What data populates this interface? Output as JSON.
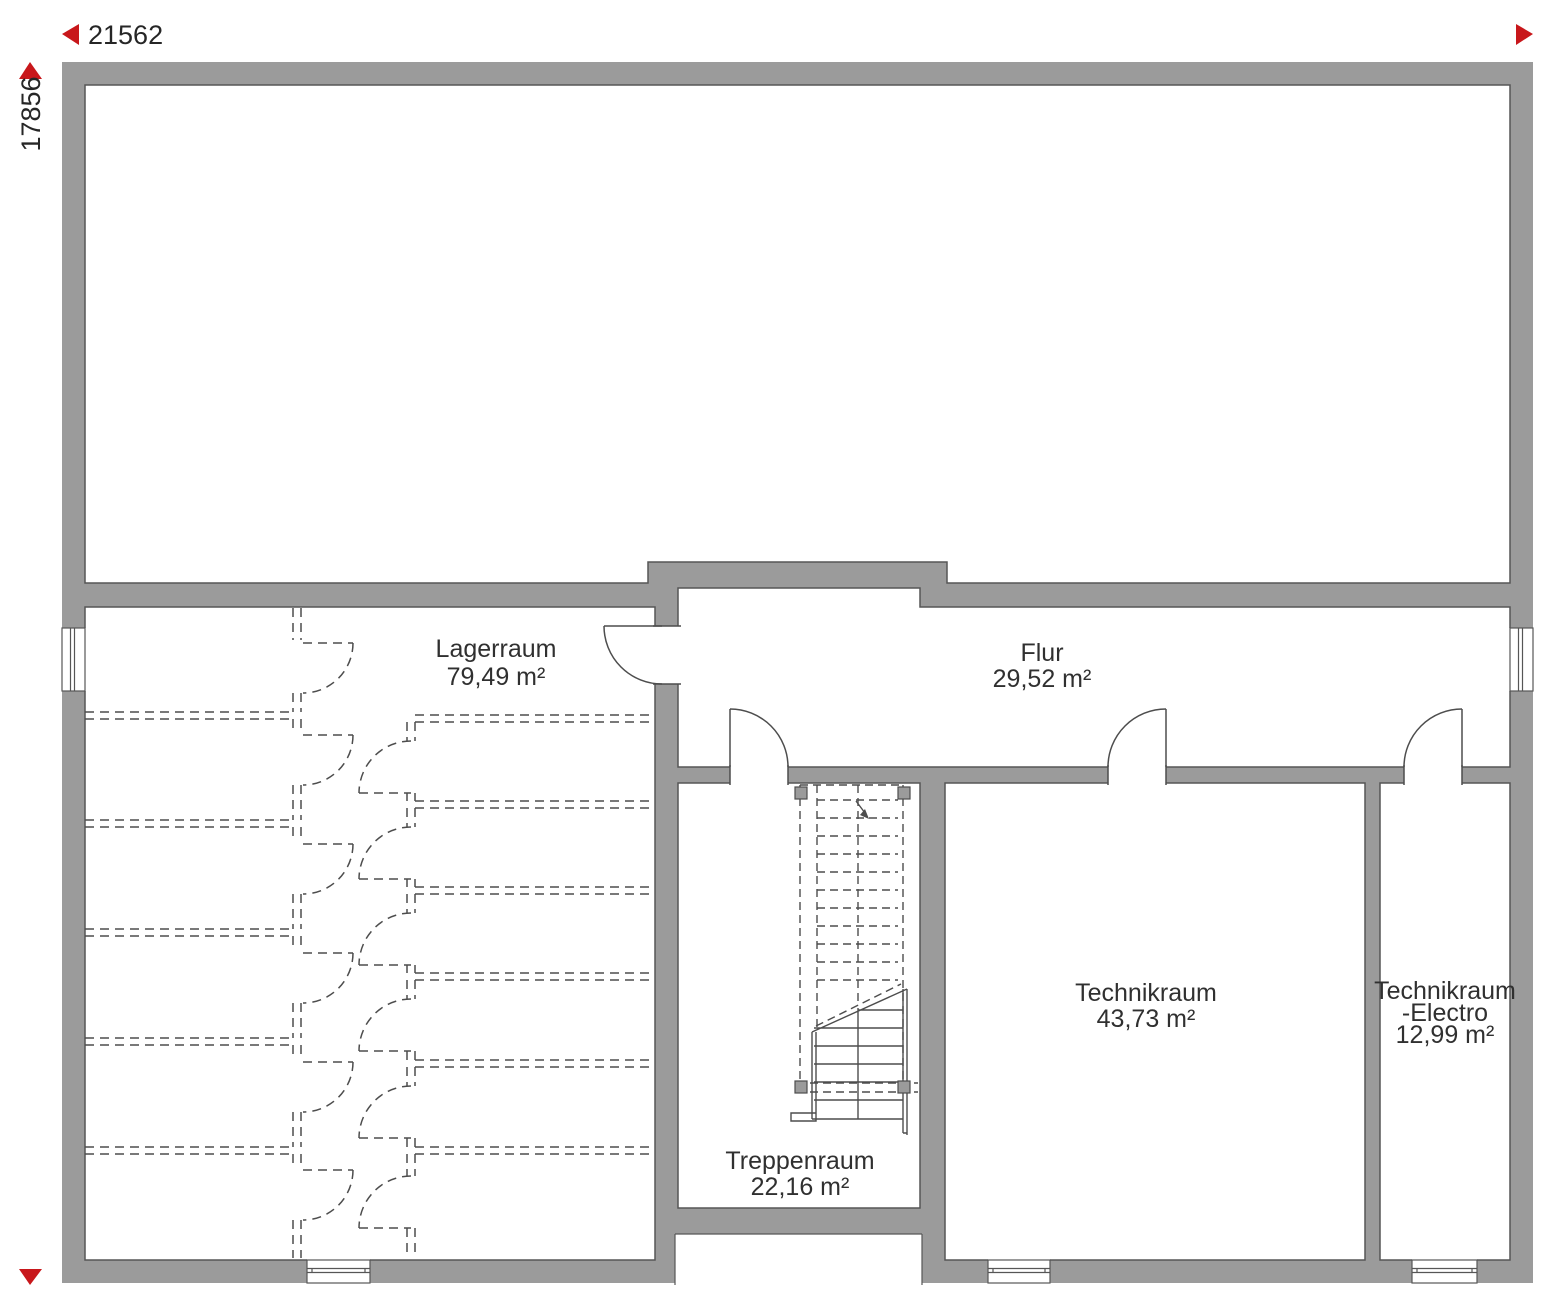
{
  "colors": {
    "wall_fill": "#9b9b9b",
    "wall_outline": "#565656",
    "line": "#4d4d4d",
    "label_text": "#303030",
    "marker_red": "#c8171b"
  },
  "dimension_markers": {
    "horizontal": {
      "value": "21562",
      "left_arrow": "triangle-left-icon",
      "right_arrow": "triangle-right-icon"
    },
    "vertical": {
      "value": "17856",
      "top_arrow": "triangle-up-icon",
      "bottom_arrow": "triangle-down-icon"
    }
  },
  "rooms": {
    "lagerraum": {
      "name": "Lagerraum",
      "area": "79,49 m²"
    },
    "flur": {
      "name": "Flur",
      "area": "29,52 m²"
    },
    "treppenraum": {
      "name": "Treppenraum",
      "area": "22,16 m²"
    },
    "technikraum": {
      "name": "Technikraum",
      "area": "43,73 m²"
    },
    "technikraum_electro": {
      "name_line1": "Technikraum",
      "name_line2": "-Electro",
      "area": "12,99 m²"
    }
  }
}
